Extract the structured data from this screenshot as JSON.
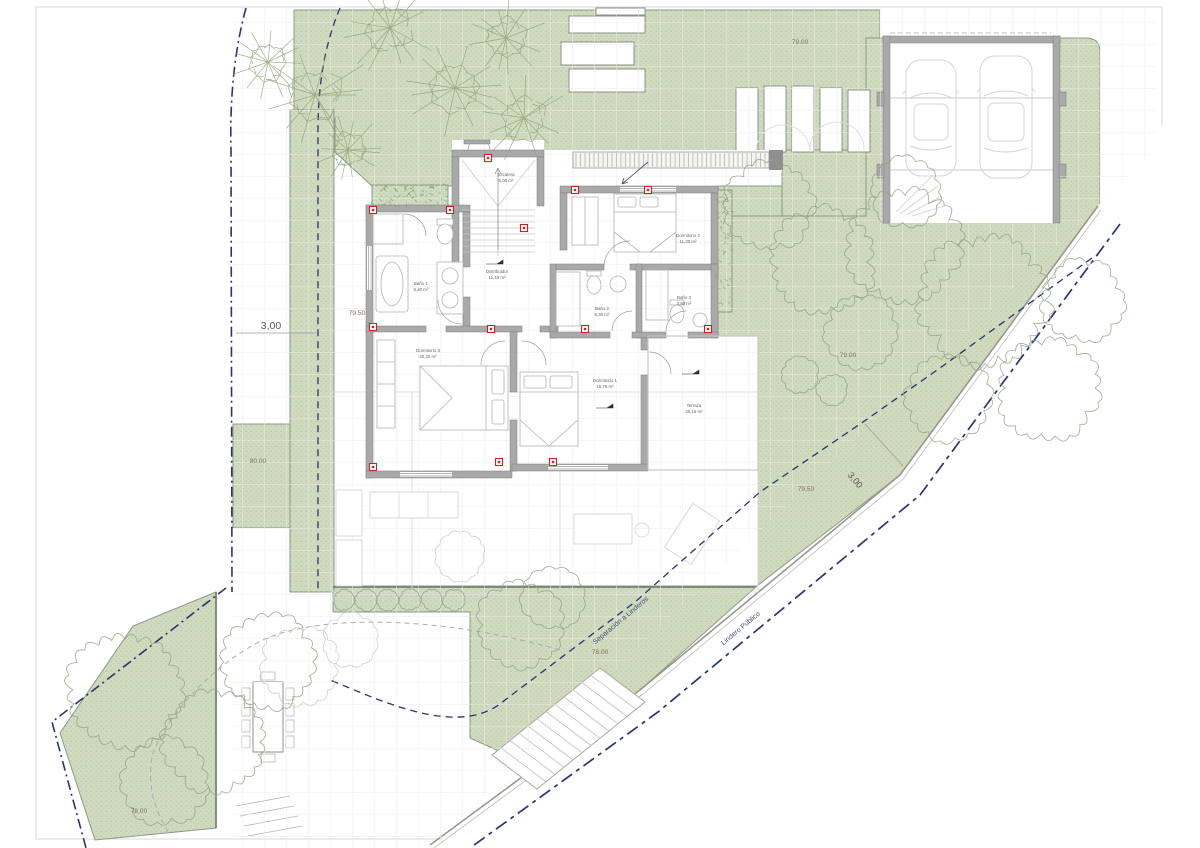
{
  "colors": {
    "green_fill": "#cfdabe",
    "green_dot": "#b7c6a3",
    "wall_gray": "#a9a9a9",
    "marker_red": "#cc2222",
    "boundary_navy": "#2a3374",
    "ghost_gray": "#dcdcda"
  },
  "rooms": {
    "escalera": {
      "name": "Escalera",
      "area": "5,00 m²"
    },
    "distribuidor": {
      "name": "Distribuidor",
      "area": "11,40 m²"
    },
    "dormitorio2": {
      "name": "Dormitorio 2",
      "area": "11,30 m²"
    },
    "bano1": {
      "name": "Baño 1",
      "area": "8,40 m²"
    },
    "bano2": {
      "name": "Baño 2",
      "area": "5,30 m²"
    },
    "bano3": {
      "name": "Baño 3",
      "area": "3,60 m²"
    },
    "dormitorio3": {
      "name": "Dormitorio 3",
      "area": "20,20 m²"
    },
    "dormitorio1": {
      "name": "Dormitorio 1",
      "area": "16,75 m²"
    },
    "terraza": {
      "name": "Terraza",
      "area": "20,15 m²"
    }
  },
  "levels": {
    "l1": "79.00",
    "l2": "79.50",
    "l3": "80.00",
    "l4": "79.00",
    "l5": "79.50",
    "l6": "78.00",
    "l7": "78.00"
  },
  "dimensions": {
    "left_setback": "3,00",
    "right_setback": "3,00"
  },
  "boundaries": {
    "setback_label": "Separación a Linderos",
    "public_label": "Lindero Público"
  }
}
